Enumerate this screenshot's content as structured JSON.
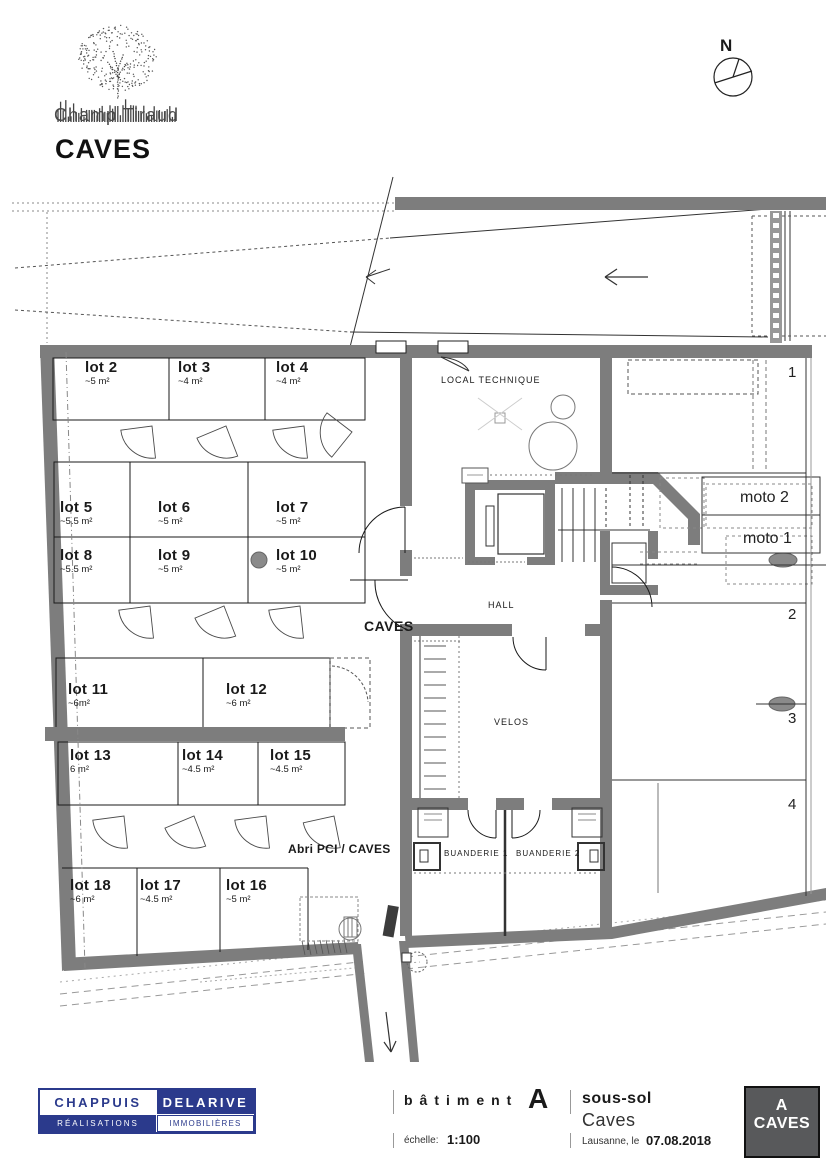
{
  "header": {
    "project": "Champ Tiraud",
    "title": "CAVES",
    "compass": "N"
  },
  "plan": {
    "lots": [
      {
        "name": "lot 2",
        "area": "~5 m²"
      },
      {
        "name": "lot 3",
        "area": "~4 m²"
      },
      {
        "name": "lot 4",
        "area": "~4 m²"
      },
      {
        "name": "lot 5",
        "area": "~5.5 m²"
      },
      {
        "name": "lot 6",
        "area": "~5 m²"
      },
      {
        "name": "lot 7",
        "area": "~5 m²"
      },
      {
        "name": "lot 8",
        "area": "~5.5 m²"
      },
      {
        "name": "lot 9",
        "area": "~5 m²"
      },
      {
        "name": "lot 10",
        "area": "~5 m²"
      },
      {
        "name": "lot 11",
        "area": "~6m²"
      },
      {
        "name": "lot 12",
        "area": "~6 m²"
      },
      {
        "name": "lot 13",
        "area": "6 m²"
      },
      {
        "name": "lot 14",
        "area": "~4.5 m²"
      },
      {
        "name": "lot 15",
        "area": "~4.5 m²"
      },
      {
        "name": "lot 16",
        "area": "~5 m²"
      },
      {
        "name": "lot 17",
        "area": "~4.5 m²"
      },
      {
        "name": "lot 18",
        "area": "~6 m²"
      }
    ],
    "rooms": {
      "local_technique": "LOCAL TECHNIQUE",
      "caves": "CAVES",
      "hall": "HALL",
      "velos": "VELOS",
      "buanderie1": "BUANDERIE 1",
      "buanderie2": "BUANDERIE 2",
      "abri": "Abri PCI / CAVES"
    },
    "parking": {
      "stalls": [
        "1",
        "2",
        "3",
        "4"
      ],
      "moto": [
        "moto 2",
        "moto 1"
      ]
    }
  },
  "footer": {
    "company": {
      "line1a": "CHAPPUIS",
      "line1b": "DELARIVE",
      "line2a": "RÉALISATIONS",
      "line2b": "IMMOBILIÈRES"
    },
    "batiment_label": "bâtiment",
    "batiment_value": "A",
    "level_label": "sous-sol",
    "level_value": "Caves",
    "scale_label": "échelle:",
    "scale_value": "1:100",
    "place_label": "Lausanne, le",
    "date": "07.08.2018",
    "badge": {
      "line1": "A",
      "line2": "CAVES"
    }
  },
  "colors": {
    "wall_gray": "#7d7d7d",
    "line_black": "#1a1a1a",
    "brand_blue": "#2b3a8c",
    "badge_gray": "#58595b"
  }
}
